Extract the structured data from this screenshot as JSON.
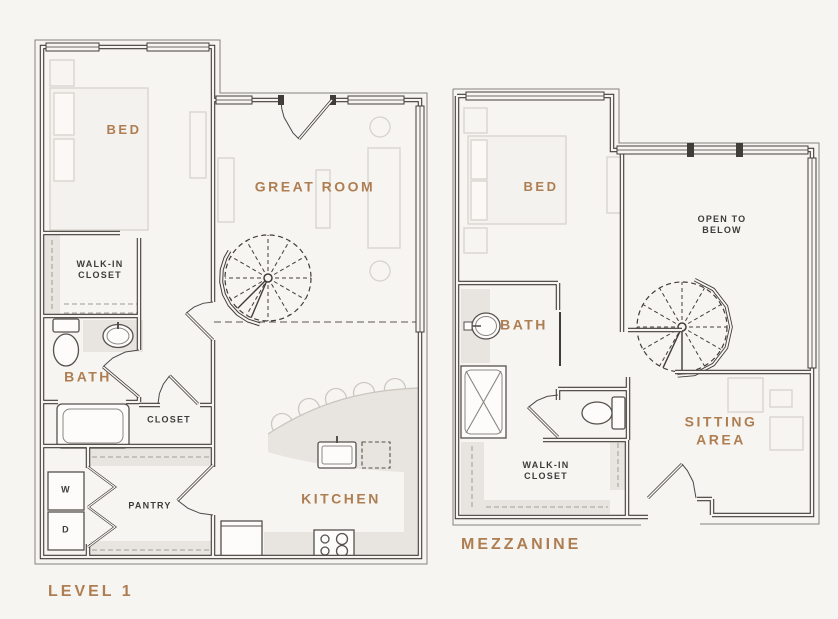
{
  "document": {
    "type": "floor-plan",
    "units_shown": 2
  },
  "colors": {
    "background": "#f7f5f2",
    "accent_label": "#ae7e52",
    "dark_label": "#3d3c39",
    "wall": "#403d39",
    "fixture_line": "#55524d",
    "furniture_line": "#d7d3cc",
    "area_fill": "#e8e5e0"
  },
  "plans": {
    "level1": {
      "title": "LEVEL 1",
      "labels": {
        "bed": "BED",
        "great_room": "GREAT ROOM",
        "walk_in_closet": "WALK-IN\nCLOSET",
        "bath": "BATH",
        "closet": "CLOSET",
        "pantry": "PANTRY",
        "kitchen": "KITCHEN",
        "washer": "W",
        "dryer": "D"
      }
    },
    "mezzanine": {
      "title": "MEZZANINE",
      "labels": {
        "bed": "BED",
        "open_to_below": "OPEN TO\nBELOW",
        "bath": "BATH",
        "walk_in_closet": "WALK-IN\nCLOSET",
        "sitting_area": "SITTING AREA"
      }
    }
  }
}
